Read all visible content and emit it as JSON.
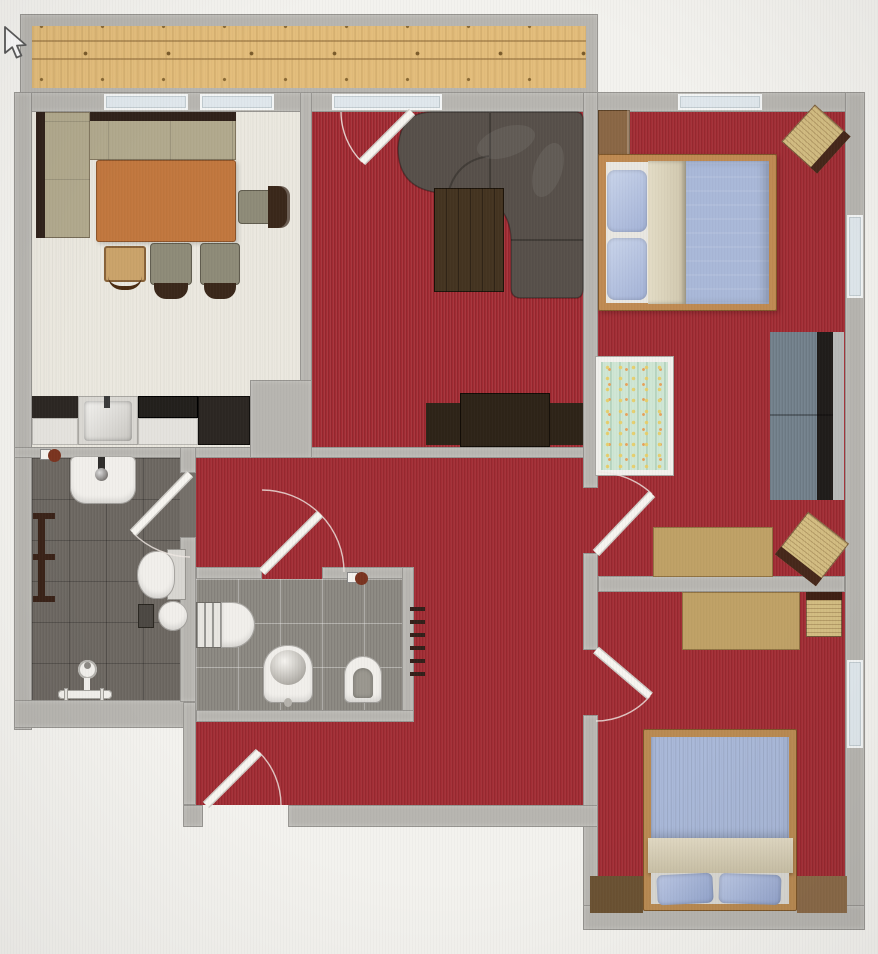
{
  "app": {
    "view": "2d-floor-plan"
  },
  "palette": {
    "background": "#f3f2ee",
    "wall": "#b7b5b0",
    "red_carpet": "#a22b33",
    "dining_floor": "#ebe8df",
    "wood_deck": "#e3bd7b",
    "tile_dark": "#6b6660",
    "tile_light": "#8d8a83",
    "sofa_gray": "#57504a",
    "coffee_table": "#443421",
    "sideboard": "#2e2418",
    "table_wood": "#c1773e",
    "bench_cushion": "#b1a98d",
    "bench_rail": "#30221a",
    "chair_seat": "#8e8b78",
    "counter_dark": "#2c2723",
    "counter_light": "#d9d7d2",
    "bed_frame": "#bf8a52",
    "duvet_blue": "#a9b8d8",
    "pillow_blue": "#b7c4e0",
    "blanket_beige": "#d6cdb6",
    "sheet_white": "#e9e7e1",
    "crib_mint": "#cfe6d4",
    "wardrobe_brown": "#8a6745",
    "desk_wood": "#bfa166",
    "sofa2_seat": "#75838e",
    "sofa2_back": "#201d1b",
    "corner_brown_left": "#6b5233",
    "corner_brown_right": "#8a6a48",
    "door_leaf": "#f7f5f0",
    "swing_arc": "#f0e9e4",
    "radiator_dash": "#33201a",
    "window_glass": "#dfe7ec"
  },
  "rooms": {
    "balcony": {
      "name": "Balcony with wood decking"
    },
    "kitchen": {
      "name": "Kitchen / dining room"
    },
    "living": {
      "name": "Living room"
    },
    "bedroom1": {
      "name": "Bedroom top right"
    },
    "bedroom2": {
      "name": "Bedroom bottom right"
    },
    "bathroom": {
      "name": "Bathroom"
    },
    "wc": {
      "name": "WC"
    },
    "hallway": {
      "name": "Hallway"
    }
  },
  "furniture": {
    "corner_bench": {
      "name": "Corner bench"
    },
    "dining_table": {
      "name": "Dining table"
    },
    "dining_chair": {
      "name": "Dining chair"
    },
    "kids_chair": {
      "name": "Wooden kids chair"
    },
    "kitchen_counter": {
      "name": "Kitchen counter with sink and cooktop"
    },
    "corner_sofa": {
      "name": "Corner sofa"
    },
    "coffee_table": {
      "name": "Coffee table"
    },
    "sideboard": {
      "name": "TV sideboard"
    },
    "double_bed": {
      "name": "Double bed"
    },
    "crib": {
      "name": "Baby crib"
    },
    "wardrobe": {
      "name": "Wardrobe"
    },
    "two_seat_sofa": {
      "name": "Two-seat sofa"
    },
    "desk_top": {
      "name": "Desk (top bedroom)"
    },
    "desk_bottom": {
      "name": "Desk (bottom bedroom)"
    },
    "wicker_chair": {
      "name": "Wicker chair"
    },
    "single_bed": {
      "name": "Bed with foot pillows"
    },
    "low_dresser_left": {
      "name": "Low dresser left"
    },
    "low_dresser_right": {
      "name": "Low dresser right"
    }
  },
  "fixtures": {
    "washbasin": {
      "name": "Washbasin"
    },
    "towel_radiator": {
      "name": "Towel radiator"
    },
    "toilet_bath": {
      "name": "Toilet (bathroom)"
    },
    "shower_set": {
      "name": "Shower fitting"
    },
    "waste_bin": {
      "name": "Waste bin"
    },
    "round_stool": {
      "name": "Round stool"
    },
    "toilet_wc": {
      "name": "Toilet (WC)"
    },
    "bidet": {
      "name": "Bidet"
    },
    "urinal": {
      "name": "Urinal"
    },
    "wall_radiator": {
      "name": "Wall radiator"
    },
    "valve": {
      "name": "Radiator valve"
    }
  },
  "doors": {
    "balcony_door": {
      "name": "Balcony door"
    },
    "bathroom_door": {
      "name": "Bathroom door"
    },
    "wc_door": {
      "name": "WC door"
    },
    "entrance_door": {
      "name": "Entrance door"
    },
    "bedroom1_door": {
      "name": "Door to top bedroom"
    },
    "bedroom2_door": {
      "name": "Door to bottom bedroom"
    }
  },
  "cursor": {
    "icon": "mouse-pointer"
  }
}
